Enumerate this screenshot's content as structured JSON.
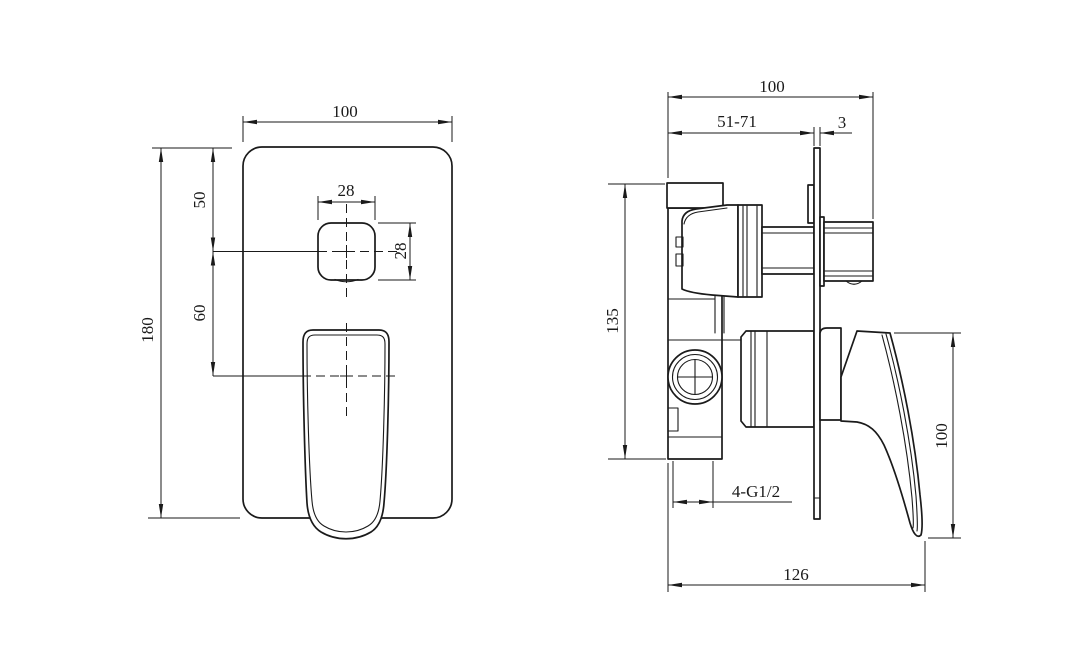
{
  "background": "#ffffff",
  "line_color": "#1a1a1a",
  "front_view": {
    "plate_width": "100",
    "plate_height": "180",
    "plate_top_to_button_center": "50",
    "button_center_to_handle_center": "60",
    "button_width": "28",
    "button_height": "28"
  },
  "side_view": {
    "overall_depth": "100",
    "installation_depth": "51-71",
    "plate_thickness": "3",
    "body_height": "135",
    "port_thread": "4-G1/2",
    "overall_length": "126",
    "handle_height": "100"
  }
}
